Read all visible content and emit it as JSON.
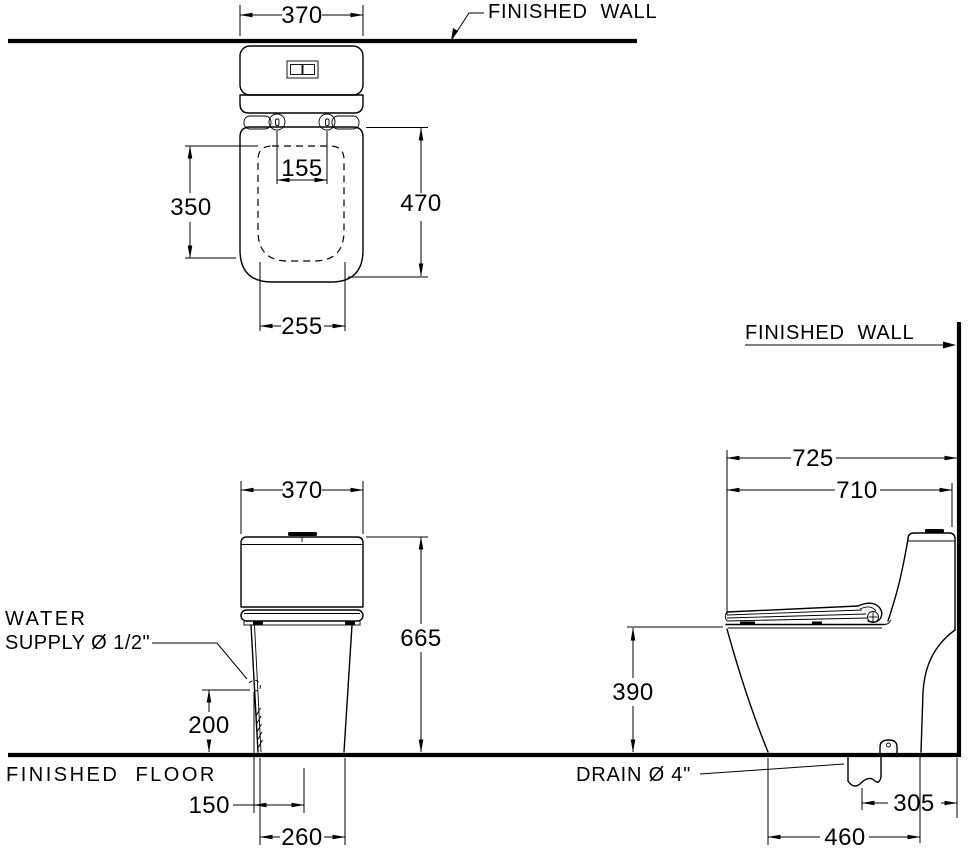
{
  "drawing": {
    "title": "One-piece toilet installation dimension drawing",
    "line_color": "#000000",
    "background": "#ffffff"
  },
  "labels": {
    "finished_wall_top": "FINISHED  WALL",
    "finished_wall_side": "FINISHED  WALL",
    "finished_floor": "FINISHED  FLOOR",
    "water_supply_line1": "WATER",
    "water_supply_line2": "SUPPLY Ø 1/2\"",
    "drain": "DRAIN Ø 4\""
  },
  "views": {
    "plan": {
      "dims": {
        "tank_width": "370",
        "hinge_spacing": "155",
        "opening_length": "350",
        "seat_length": "470",
        "opening_width": "255"
      }
    },
    "front": {
      "dims": {
        "tank_width": "370",
        "overall_height": "665",
        "supply_height": "200",
        "supply_offset": "150",
        "base_width": "260"
      }
    },
    "side": {
      "dims": {
        "overall_depth": "725",
        "body_depth": "710",
        "rim_height": "390",
        "rough_in": "305",
        "base_depth": "460"
      }
    }
  }
}
